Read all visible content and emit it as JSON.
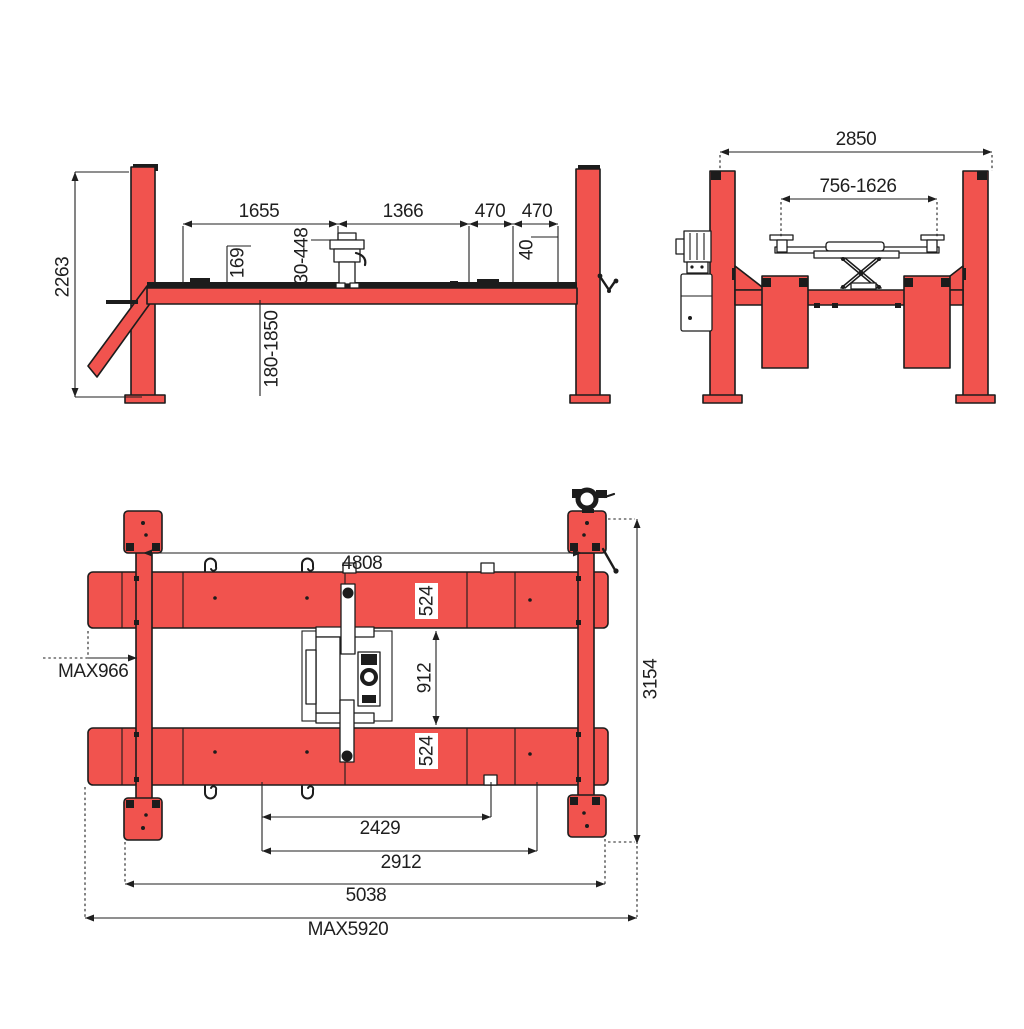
{
  "colors": {
    "lift_red": "#f1534e",
    "outline": "#1c1c1c",
    "dim_text": "#1f1f1f",
    "background": "#ffffff"
  },
  "views": {
    "side": {
      "dims": {
        "overall_height": "2263",
        "section_1655": "1655",
        "section_1366": "1366",
        "section_470a": "470",
        "section_470b": "470",
        "wheel_stop_height": "40",
        "rail_height": "169",
        "jack_pad_range": "30-448",
        "lift_height_range": "180-1850"
      }
    },
    "front": {
      "dims": {
        "overall_width": "2850",
        "jack_arm_span": "756-1626"
      }
    },
    "plan": {
      "dims": {
        "post_span_length": "4808",
        "runway_width_front": "524",
        "runway_width_rear": "524",
        "runway_gap": "912",
        "side_extension_max": "MAX966",
        "outer_width": "3154",
        "span_2429": "2429",
        "span_2912": "2912",
        "span_5038": "5038",
        "overall_length_max": "MAX5920"
      }
    }
  }
}
